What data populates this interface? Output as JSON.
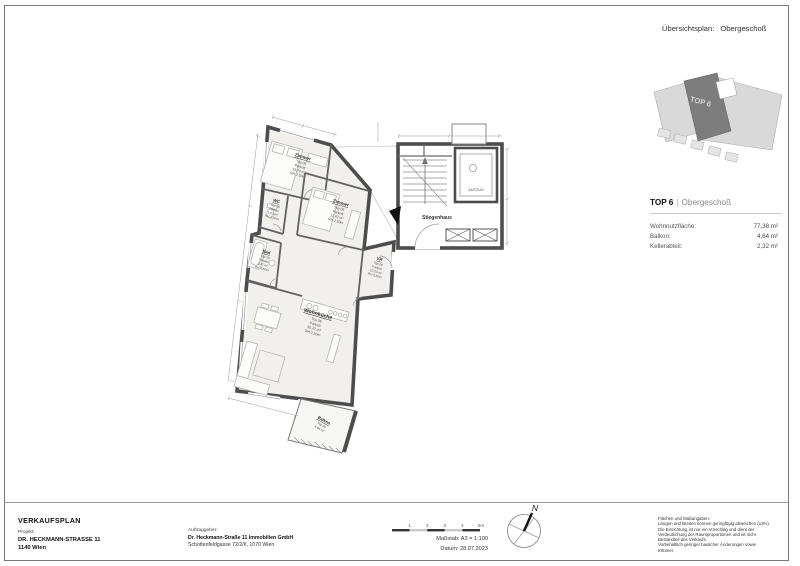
{
  "overview": {
    "title_label": "Übersichtsplan:",
    "title_value": "Obergeschoß",
    "top_label": "TOP 6"
  },
  "unit_info": {
    "name": "TOP 6",
    "separator": "|",
    "floor": "Obergeschoß",
    "rows": [
      {
        "label": "Wohnnutzfläche:",
        "value": "77,38 m²"
      },
      {
        "label": "Balkon:",
        "value": "4,64 m²"
      },
      {
        "label": "Kellerabteil:",
        "value": "2,32 m²"
      }
    ]
  },
  "plan": {
    "stairwell_label": "Stiegenhaus",
    "elevator_label": "AUFZUG",
    "rooms": [
      {
        "name": "Zimmer",
        "top": "Top 06",
        "floor": "Parkett",
        "area": "13,74 m²",
        "rh": "RH 2,50m"
      },
      {
        "name": "WC",
        "top": "Top 06",
        "floor": "Fliesen",
        "area": "1,63 m²",
        "rh": "RH 2,50m"
      },
      {
        "name": "Zimmer",
        "top": "Top 06",
        "floor": "Parkett",
        "area": "11,42 m²",
        "rh": "RH 2,50m"
      },
      {
        "name": "Bad",
        "top": "Top 06",
        "floor": "Fliesen",
        "area": "3,37 m²",
        "rh": "RH 2,50m"
      },
      {
        "name": "VR",
        "top": "Top 06",
        "floor": "Parkett",
        "area": "10,20 m²",
        "rh": "RH 2,50m"
      },
      {
        "name": "Wohnküche",
        "top": "Top 06",
        "floor": "Parkett",
        "area": "30,47 m²",
        "rh": "RH 2,50m"
      },
      {
        "name": "Balkon",
        "top": "Top 06",
        "area": "4,64 m²"
      }
    ]
  },
  "title_block": {
    "title": "VERKAUFSPLAN",
    "project_label": "Projekt:",
    "project_line1": "DR. HECKMANN-STRASSE 11",
    "project_line2": "1140 Wien",
    "client_label": "Auftraggeber:",
    "client_line1": "Dr. Heckmann-Straße 11 Immobilien GmbH",
    "client_line2": "Schottenfeldgasse 72/2/II, 1070 Wien",
    "scale_label": "Maßstab: A3 = 1:100",
    "date_label": "Datum: 28.07.2023",
    "scale_ticks": [
      "1",
      "2",
      "3",
      "4",
      "5m"
    ],
    "compass_label": "N",
    "disclaimer": [
      "Flächen und Maßangaben:",
      "Längen und Breiten können geringfügig abweichen (±3%).",
      "Die Einrichtung ist nur ein Vorschlag und dient der",
      "Verdeutlichung der Raumproportionen und ist nicht",
      "Bestandteil des Verkaufs.",
      "Vorbehaltlich geringer baulicher Änderungen sowie",
      "Irrtümer."
    ]
  },
  "colors": {
    "wall": "#4d4d4d",
    "room_fill": "#f1f0ec",
    "overview_light": "#d9d9d9",
    "overview_dark": "#7d7d7d"
  }
}
